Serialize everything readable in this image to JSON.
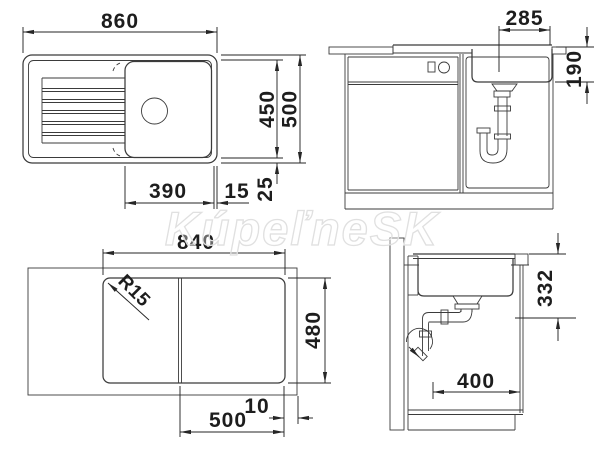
{
  "watermark": {
    "text": "KúpeľneSK"
  },
  "dims": {
    "top_plan": {
      "width": "860",
      "inner_depth": "450",
      "depth": "500",
      "bowl_width": "390",
      "gap_right": "15",
      "gap_bottom": "25"
    },
    "front_section": {
      "bowl_width": "285",
      "bowl_depth": "190"
    },
    "cutout_plan": {
      "width": "840",
      "depth": "480",
      "bowl_zone_width": "500",
      "edge_offset": "10",
      "corner_radius": "R15"
    },
    "side_section": {
      "drain_height": "332",
      "clearance_depth": "400"
    }
  },
  "colors": {
    "line": "#3b3b3b",
    "dimension": "#262626",
    "watermark_outline": "#e0e0e0",
    "background": "#ffffff"
  }
}
